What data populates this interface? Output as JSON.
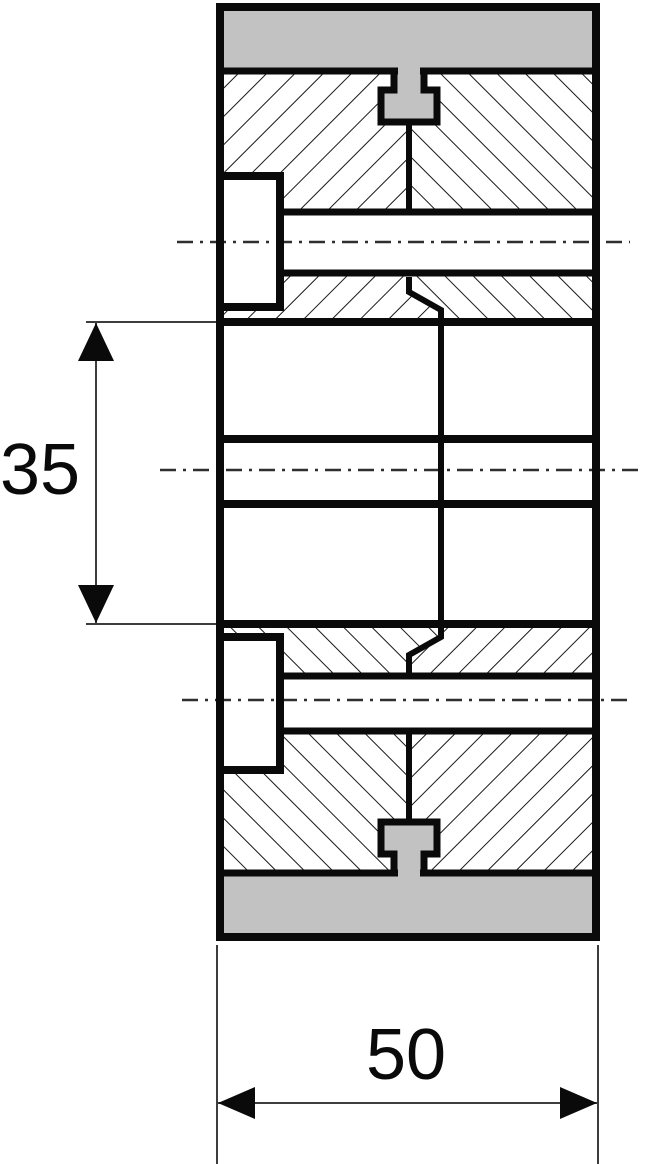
{
  "page": {
    "background": "#ffffff"
  },
  "drawing": {
    "kind": "engineering-cross-section-wheel",
    "dimensions": [
      {
        "id": "hub-length",
        "label": "35",
        "orientation": "vertical"
      },
      {
        "id": "overall-width",
        "label": "50",
        "orientation": "horizontal"
      }
    ],
    "colors": {
      "line": "#0a0a0a",
      "tread": "#c2c2c2",
      "background": "#ffffff",
      "dim": "#3d3d3d"
    }
  }
}
